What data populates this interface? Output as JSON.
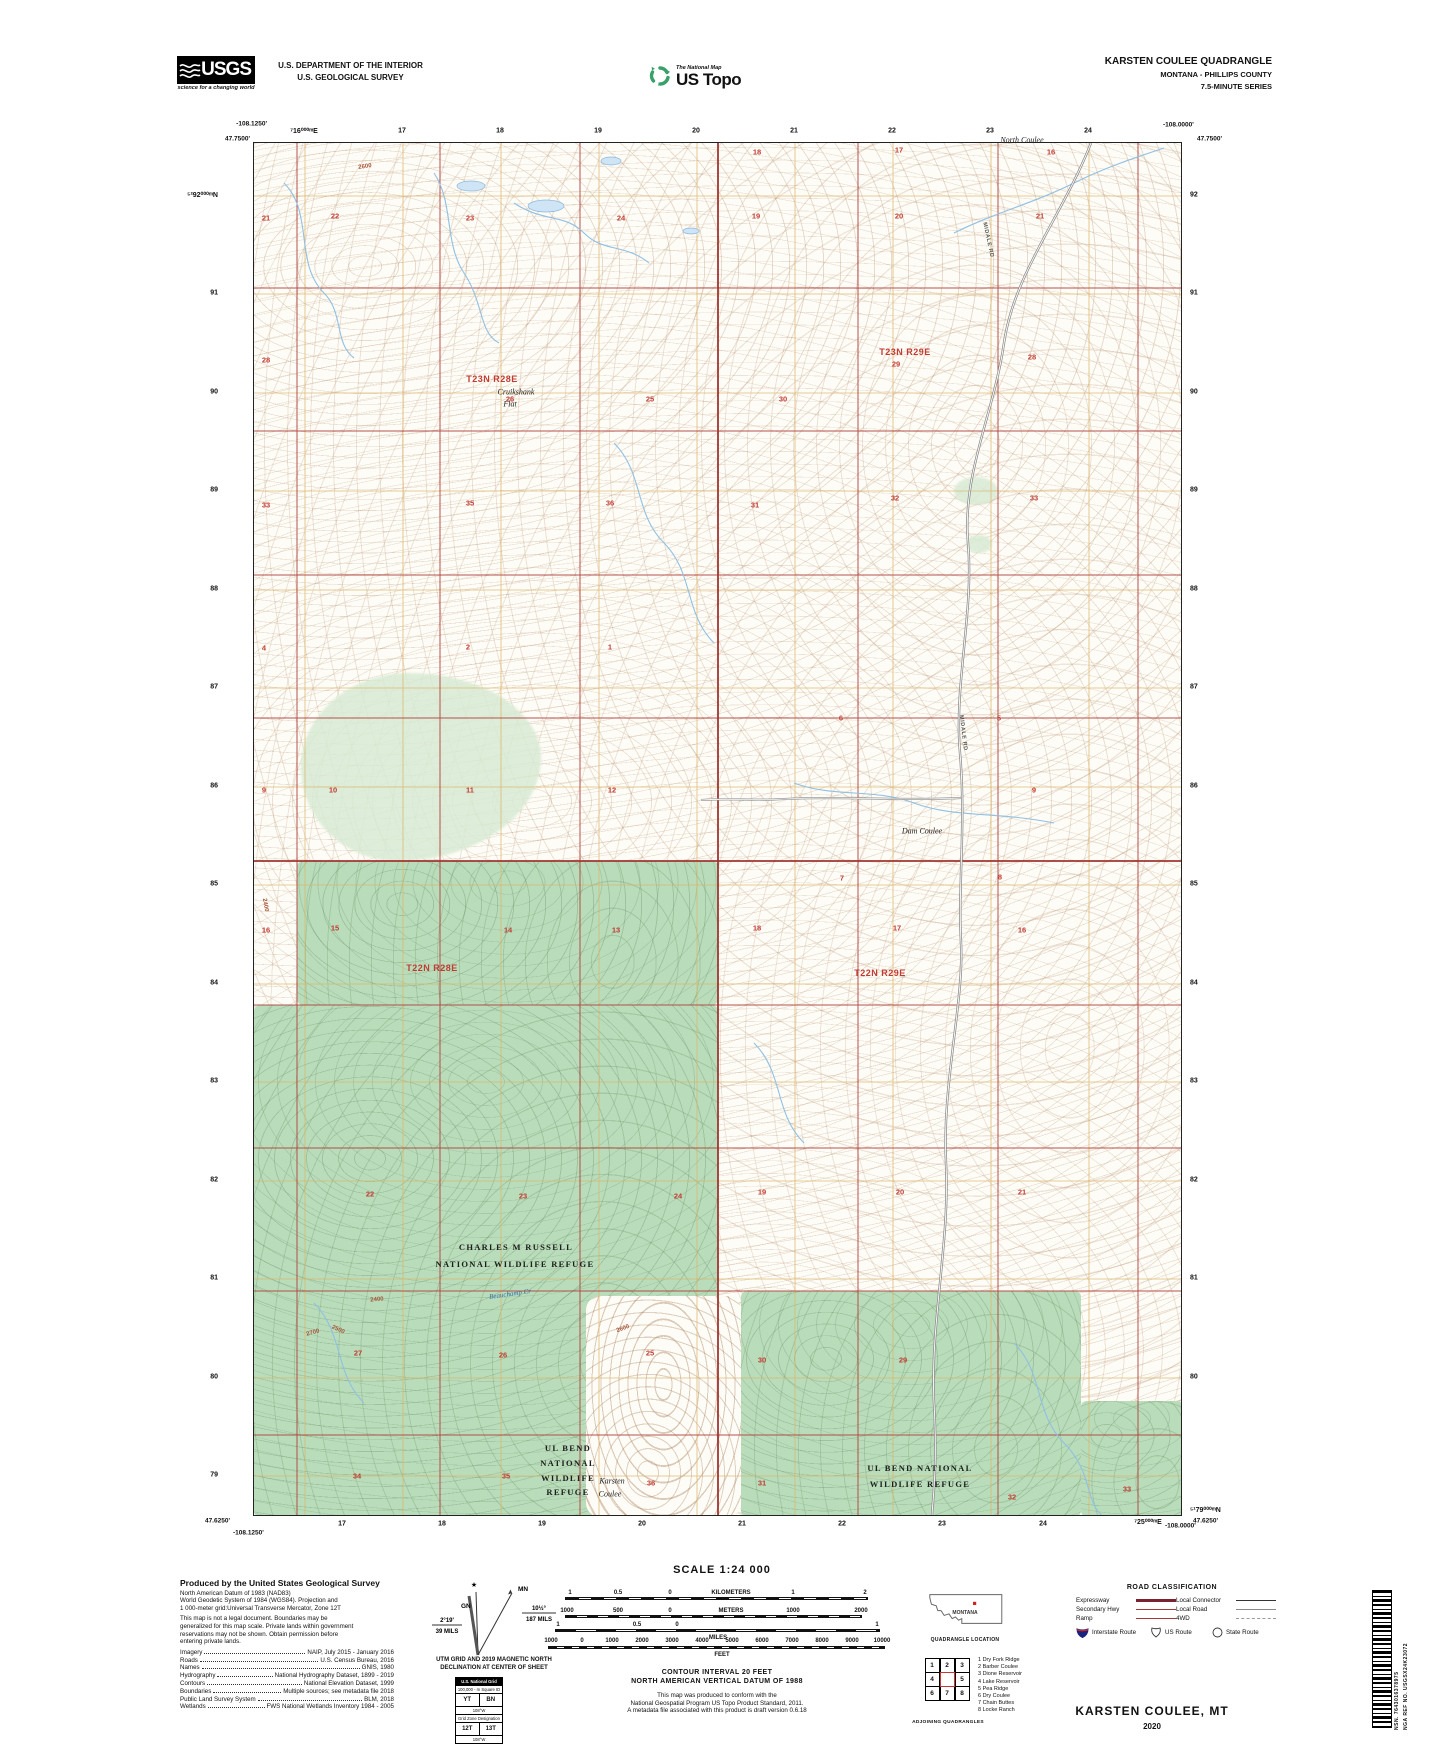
{
  "colors": {
    "refuge_green": "#b9dcba",
    "grid_orange": "#dcb264",
    "section_red": "#b0413e",
    "water_blue": "#90c0e4",
    "contour_brown": "#b08968",
    "usgs_green": "#39a06a"
  },
  "header": {
    "usgs": {
      "name": "USGS",
      "tagline": "science for a changing world"
    },
    "dept_line1": "U.S. DEPARTMENT OF THE INTERIOR",
    "dept_line2": "U.S. GEOLOGICAL SURVEY",
    "ustopo": {
      "program": "The National Map",
      "product": "US Topo"
    },
    "quad_title": "KARSTEN COULEE QUADRANGLE",
    "quad_state": "MONTANA - PHILLIPS COUNTY",
    "quad_series": "7.5-MINUTE SERIES"
  },
  "map": {
    "corners": {
      "tl_lon": "-108.1250'",
      "tl_lat": "47.7500'",
      "tr_lon": "-108.0000'",
      "tr_lat": "47.7500'",
      "bl_lat": "47.6250'",
      "bl_lon": "-108.1250'",
      "br_lon": "-108.0000'",
      "br_lat": "47.6250'"
    },
    "top_labels": [
      {
        "t": "⁷16⁰⁰⁰ᵐE",
        "x": 304,
        "y": 131
      },
      {
        "t": "17",
        "x": 402,
        "y": 131
      },
      {
        "t": "18",
        "x": 500,
        "y": 131
      },
      {
        "t": "19",
        "x": 598,
        "y": 131
      },
      {
        "t": "20",
        "x": 696,
        "y": 131
      },
      {
        "t": "21",
        "x": 794,
        "y": 131
      },
      {
        "t": "22",
        "x": 892,
        "y": 131
      },
      {
        "t": "23",
        "x": 990,
        "y": 131
      },
      {
        "t": "24",
        "x": 1088,
        "y": 131
      }
    ],
    "bottom_labels": [
      {
        "t": "17",
        "x": 342,
        "y": 1524
      },
      {
        "t": "18",
        "x": 442,
        "y": 1524
      },
      {
        "t": "19",
        "x": 542,
        "y": 1524
      },
      {
        "t": "20",
        "x": 642,
        "y": 1524
      },
      {
        "t": "21",
        "x": 742,
        "y": 1524
      },
      {
        "t": "22",
        "x": 842,
        "y": 1524
      },
      {
        "t": "23",
        "x": 942,
        "y": 1524
      },
      {
        "t": "24",
        "x": 1043,
        "y": 1524
      },
      {
        "t": "⁷25⁰⁰⁰ᵐE",
        "x": 1148,
        "y": 1522
      }
    ],
    "left_labels": [
      {
        "t": "⁵²92⁰⁰⁰ᵐN",
        "x": 218,
        "y": 195
      },
      {
        "t": "91",
        "x": 218,
        "y": 293
      },
      {
        "t": "90",
        "x": 218,
        "y": 392
      },
      {
        "t": "89",
        "x": 218,
        "y": 490
      },
      {
        "t": "88",
        "x": 218,
        "y": 589
      },
      {
        "t": "87",
        "x": 218,
        "y": 687
      },
      {
        "t": "86",
        "x": 218,
        "y": 786
      },
      {
        "t": "85",
        "x": 218,
        "y": 884
      },
      {
        "t": "84",
        "x": 218,
        "y": 983
      },
      {
        "t": "83",
        "x": 218,
        "y": 1081
      },
      {
        "t": "82",
        "x": 218,
        "y": 1180
      },
      {
        "t": "81",
        "x": 218,
        "y": 1278
      },
      {
        "t": "80",
        "x": 218,
        "y": 1377
      },
      {
        "t": "79",
        "x": 218,
        "y": 1475
      }
    ],
    "right_labels": [
      {
        "t": "92",
        "x": 1190,
        "y": 195
      },
      {
        "t": "91",
        "x": 1190,
        "y": 293
      },
      {
        "t": "90",
        "x": 1190,
        "y": 392
      },
      {
        "t": "89",
        "x": 1190,
        "y": 490
      },
      {
        "t": "88",
        "x": 1190,
        "y": 589
      },
      {
        "t": "87",
        "x": 1190,
        "y": 687
      },
      {
        "t": "86",
        "x": 1190,
        "y": 786
      },
      {
        "t": "85",
        "x": 1190,
        "y": 884
      },
      {
        "t": "84",
        "x": 1190,
        "y": 983
      },
      {
        "t": "83",
        "x": 1190,
        "y": 1081
      },
      {
        "t": "82",
        "x": 1190,
        "y": 1180
      },
      {
        "t": "81",
        "x": 1190,
        "y": 1278
      },
      {
        "t": "80",
        "x": 1190,
        "y": 1377
      },
      {
        "t": "⁵¹79⁰⁰⁰ᵐN",
        "x": 1190,
        "y": 1510
      }
    ],
    "townships": [
      {
        "t": "T23N R28E",
        "x": 492,
        "y": 379
      },
      {
        "t": "T23N R29E",
        "x": 905,
        "y": 352
      },
      {
        "t": "T22N R28E",
        "x": 432,
        "y": 968
      },
      {
        "t": "T22N R29E",
        "x": 880,
        "y": 973
      }
    ],
    "sections": [
      {
        "t": "18",
        "x": 757,
        "y": 152
      },
      {
        "t": "17",
        "x": 899,
        "y": 150
      },
      {
        "t": "16",
        "x": 1051,
        "y": 152
      },
      {
        "t": "21",
        "x": 266,
        "y": 218
      },
      {
        "t": "22",
        "x": 335,
        "y": 216
      },
      {
        "t": "23",
        "x": 470,
        "y": 218
      },
      {
        "t": "24",
        "x": 621,
        "y": 218
      },
      {
        "t": "19",
        "x": 756,
        "y": 216
      },
      {
        "t": "20",
        "x": 899,
        "y": 216
      },
      {
        "t": "21",
        "x": 1040,
        "y": 216
      },
      {
        "t": "28",
        "x": 266,
        "y": 360
      },
      {
        "t": "26",
        "x": 510,
        "y": 399
      },
      {
        "t": "25",
        "x": 650,
        "y": 399
      },
      {
        "t": "30",
        "x": 783,
        "y": 399
      },
      {
        "t": "29",
        "x": 896,
        "y": 364
      },
      {
        "t": "28",
        "x": 1032,
        "y": 357
      },
      {
        "t": "33",
        "x": 266,
        "y": 505
      },
      {
        "t": "35",
        "x": 470,
        "y": 503
      },
      {
        "t": "36",
        "x": 610,
        "y": 503
      },
      {
        "t": "31",
        "x": 755,
        "y": 505
      },
      {
        "t": "32",
        "x": 895,
        "y": 498
      },
      {
        "t": "33",
        "x": 1034,
        "y": 498
      },
      {
        "t": "4",
        "x": 264,
        "y": 648
      },
      {
        "t": "2",
        "x": 468,
        "y": 647
      },
      {
        "t": "1",
        "x": 610,
        "y": 647
      },
      {
        "t": "6",
        "x": 841,
        "y": 718
      },
      {
        "t": "5",
        "x": 999,
        "y": 718
      },
      {
        "t": "9",
        "x": 264,
        "y": 790
      },
      {
        "t": "10",
        "x": 333,
        "y": 790
      },
      {
        "t": "11",
        "x": 470,
        "y": 790
      },
      {
        "t": "12",
        "x": 612,
        "y": 790
      },
      {
        "t": "7",
        "x": 842,
        "y": 878
      },
      {
        "t": "8",
        "x": 1000,
        "y": 877
      },
      {
        "t": "9",
        "x": 1034,
        "y": 790
      },
      {
        "t": "16",
        "x": 266,
        "y": 930
      },
      {
        "t": "15",
        "x": 335,
        "y": 928
      },
      {
        "t": "14",
        "x": 508,
        "y": 930
      },
      {
        "t": "13",
        "x": 616,
        "y": 930
      },
      {
        "t": "18",
        "x": 757,
        "y": 928
      },
      {
        "t": "17",
        "x": 897,
        "y": 928
      },
      {
        "t": "16",
        "x": 1022,
        "y": 930
      },
      {
        "t": "22",
        "x": 370,
        "y": 1194
      },
      {
        "t": "23",
        "x": 523,
        "y": 1196
      },
      {
        "t": "24",
        "x": 678,
        "y": 1196
      },
      {
        "t": "19",
        "x": 762,
        "y": 1192
      },
      {
        "t": "20",
        "x": 900,
        "y": 1192
      },
      {
        "t": "21",
        "x": 1022,
        "y": 1192
      },
      {
        "t": "27",
        "x": 358,
        "y": 1353
      },
      {
        "t": "26",
        "x": 503,
        "y": 1355
      },
      {
        "t": "25",
        "x": 650,
        "y": 1353
      },
      {
        "t": "30",
        "x": 762,
        "y": 1360
      },
      {
        "t": "29",
        "x": 903,
        "y": 1360
      },
      {
        "t": "34",
        "x": 357,
        "y": 1476
      },
      {
        "t": "35",
        "x": 506,
        "y": 1476
      },
      {
        "t": "36",
        "x": 651,
        "y": 1483
      },
      {
        "t": "31",
        "x": 762,
        "y": 1483
      },
      {
        "t": "32",
        "x": 1012,
        "y": 1497
      },
      {
        "t": "33",
        "x": 1127,
        "y": 1489
      }
    ],
    "features": [
      {
        "t": "Cruikshank",
        "x": 516,
        "y": 392
      },
      {
        "t": "Flat",
        "x": 510,
        "y": 404
      },
      {
        "t": "North Coulee",
        "x": 1022,
        "y": 140
      },
      {
        "t": "Dam Coulee",
        "x": 922,
        "y": 831
      },
      {
        "t": "Karsten",
        "x": 612,
        "y": 1481
      },
      {
        "t": "Coulee",
        "x": 610,
        "y": 1494
      }
    ],
    "water_labels": [
      {
        "t": "Beauchamp Cr",
        "x": 510,
        "y": 1294,
        "r": -8
      }
    ],
    "refuges": [
      {
        "t": "CHARLES M RUSSELL",
        "x": 516,
        "y": 1247
      },
      {
        "t": "NATIONAL WILDLIFE REFUGE",
        "x": 515,
        "y": 1264
      },
      {
        "t": "UL BEND",
        "x": 568,
        "y": 1448
      },
      {
        "t": "NATIONAL",
        "x": 568,
        "y": 1463
      },
      {
        "t": "WILDLIFE",
        "x": 568,
        "y": 1478
      },
      {
        "t": "REFUGE",
        "x": 568,
        "y": 1492
      },
      {
        "t": "UL BEND NATIONAL",
        "x": 920,
        "y": 1468
      },
      {
        "t": "WILDLIFE REFUGE",
        "x": 920,
        "y": 1484
      }
    ],
    "road_labels": [
      {
        "t": "MIDALE RD",
        "x": 988,
        "y": 240,
        "r": 78
      },
      {
        "t": "MIDALE RD",
        "x": 963,
        "y": 733,
        "r": 83
      }
    ],
    "elev_labels": [
      {
        "t": "2600",
        "x": 365,
        "y": 167,
        "r": -8
      },
      {
        "t": "2400",
        "x": 265,
        "y": 905,
        "r": 80
      },
      {
        "t": "2700",
        "x": 313,
        "y": 1333,
        "r": -15
      },
      {
        "t": "2500",
        "x": 338,
        "y": 1330,
        "r": 25
      },
      {
        "t": "2400",
        "x": 377,
        "y": 1300,
        "r": -5
      },
      {
        "t": "2600",
        "x": 623,
        "y": 1329,
        "r": -20
      }
    ]
  },
  "footer": {
    "credits": {
      "heading": "Produced by the United States Geological Survey",
      "datum_lines": [
        "North American Datum of 1983 (NAD83)",
        "World Geodetic System of 1984 (WGS84).  Projection and",
        "1 000-meter grid:Universal Transverse Mercator, Zone 12T"
      ],
      "legal_lines": [
        "This map is not a legal document. Boundaries may be",
        "generalized for this map scale. Private lands within government",
        "reservations may not be shown. Obtain permission before",
        "entering private lands."
      ],
      "sources": [
        {
          "label": "Imagery",
          "value": "NAIP, July 2015 - January 2016"
        },
        {
          "label": "Roads",
          "value": "U.S. Census Bureau, 2016"
        },
        {
          "label": "Names",
          "value": "GNIS, 1980"
        },
        {
          "label": "Hydrography",
          "value": "National Hydrography Dataset, 1899 - 2019"
        },
        {
          "label": "Contours",
          "value": "National Elevation Dataset, 1999"
        },
        {
          "label": "Boundaries",
          "value": "Multiple sources; see metadata file 2018"
        },
        {
          "label": "Public Land Survey System",
          "value": "BLM, 2018"
        },
        {
          "label": "Wetlands",
          "value": "FWS National Wetlands Inventory 1984 - 2005"
        }
      ]
    },
    "declination": {
      "star": "★",
      "mn": "MN",
      "gn": "GN",
      "mn_deg": "10½°",
      "mn_mils": "187 MILS",
      "gn_deg": "2°19'",
      "gn_mils": "39 MILS",
      "caption1": "UTM GRID AND 2019 MAGNETIC NORTH",
      "caption2": "DECLINATION AT CENTER OF SHEET"
    },
    "usng": {
      "header": "U.S. National Grid",
      "square_id": "100,000 - m Square ID",
      "sq_left": "YT",
      "sq_right": "BN",
      "lon1": "108°W",
      "zone_label": "Grid Zone Designation",
      "zone_left": "12T",
      "zone_right": "13T",
      "lon2": "108°W"
    },
    "scale": {
      "title": "SCALE 1:24 000",
      "labels": [
        {
          "t": "1",
          "x": 570,
          "y": 1593
        },
        {
          "t": "0.5",
          "x": 618,
          "y": 1593
        },
        {
          "t": "0",
          "x": 670,
          "y": 1593
        },
        {
          "t": "KILOMETERS",
          "x": 731,
          "y": 1593
        },
        {
          "t": "1",
          "x": 793,
          "y": 1593
        },
        {
          "t": "2",
          "x": 865,
          "y": 1593
        },
        {
          "t": "1000",
          "x": 567,
          "y": 1611
        },
        {
          "t": "500",
          "x": 618,
          "y": 1611
        },
        {
          "t": "0",
          "x": 670,
          "y": 1611
        },
        {
          "t": "METERS",
          "x": 731,
          "y": 1611
        },
        {
          "t": "1000",
          "x": 793,
          "y": 1611
        },
        {
          "t": "2000",
          "x": 861,
          "y": 1611
        },
        {
          "t": "1",
          "x": 558,
          "y": 1625
        },
        {
          "t": "0.5",
          "x": 637,
          "y": 1625
        },
        {
          "t": "0",
          "x": 677,
          "y": 1625
        },
        {
          "t": "1",
          "x": 877,
          "y": 1625
        },
        {
          "t": "MILES",
          "x": 718,
          "y": 1638
        },
        {
          "t": "1000",
          "x": 551,
          "y": 1641
        },
        {
          "t": "0",
          "x": 582,
          "y": 1641
        },
        {
          "t": "1000",
          "x": 612,
          "y": 1641
        },
        {
          "t": "2000",
          "x": 642,
          "y": 1641
        },
        {
          "t": "3000",
          "x": 672,
          "y": 1641
        },
        {
          "t": "4000",
          "x": 702,
          "y": 1641
        },
        {
          "t": "5000",
          "x": 732,
          "y": 1641
        },
        {
          "t": "6000",
          "x": 762,
          "y": 1641
        },
        {
          "t": "7000",
          "x": 792,
          "y": 1641
        },
        {
          "t": "8000",
          "x": 822,
          "y": 1641
        },
        {
          "t": "9000",
          "x": 852,
          "y": 1641
        },
        {
          "t": "10000",
          "x": 882,
          "y": 1641
        },
        {
          "t": "FEET",
          "x": 722,
          "y": 1655
        }
      ]
    },
    "contour_note1": "CONTOUR INTERVAL 20 FEET",
    "contour_note2": "NORTH AMERICAN VERTICAL DATUM OF 1988",
    "conform_lines": [
      "This map was produced to conform with the",
      "National Geospatial Program US Topo Product Standard, 2011.",
      "A metadata file associated with this product is draft version 0.6.18"
    ],
    "location": {
      "state": "MONTANA",
      "caption": "QUADRANGLE LOCATION"
    },
    "adjoining": {
      "grid": [
        "1",
        "2",
        "3",
        "4",
        "",
        "5",
        "6",
        "7",
        "8"
      ],
      "list": [
        "1 Dry Fork Ridge",
        "2 Barber Coulee",
        "3 Dione Reservoir",
        "4 Lake Reservoir",
        "5 Pea Ridge",
        "6 Dry Coulee",
        "7 Chain Buttes",
        "8 Locke Ranch"
      ],
      "caption": "ADJOINING QUADRANGLES"
    },
    "road_class": {
      "title": "ROAD CLASSIFICATION",
      "left_rows": [
        {
          "label": "Expressway"
        },
        {
          "label": "Secondary Hwy"
        },
        {
          "label": "Ramp"
        }
      ],
      "right_rows": [
        {
          "label": "Local Connector"
        },
        {
          "label": "Local Road"
        },
        {
          "label": "4WD"
        }
      ],
      "shield1": "Interstate Route",
      "shield2": "US Route",
      "shield3": "State Route"
    },
    "sheet": {
      "title": "KARSTEN COULEE,  MT",
      "year": "2020"
    },
    "barcode": {
      "nsn": "NSN.  7643016378975",
      "nga": "NGA REF NO.  USGSX24K23072"
    }
  }
}
